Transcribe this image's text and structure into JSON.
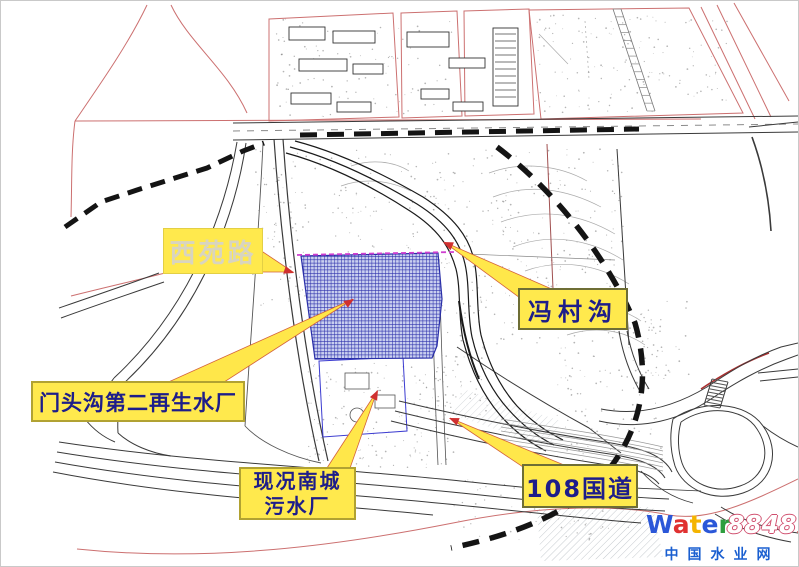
{
  "page": {
    "background": "#ffffff",
    "frame_color": "#c9c9c9"
  },
  "callouts": {
    "xiyuan_road": {
      "text": "西苑路"
    },
    "mentougou_plant": {
      "text": "门头沟第二再生水厂"
    },
    "fengcun_gou": {
      "text": "冯村沟"
    },
    "nancheng_plant": {
      "line1": "现况南城",
      "line2": "污水厂"
    },
    "g108": {
      "text": "108国道"
    }
  },
  "colors": {
    "label_bg": "#ffe94d",
    "label_text_blue": "#1d1d8a",
    "label_text_pale": "#d8d4c0",
    "site_hatch_blue": "#2d31ab",
    "boundary_dash": "#141414",
    "parcel_red": "#cc7070",
    "arrow_red": "#d03030",
    "magenta_edge": "#cf3fd0"
  },
  "watermark": {
    "brand_letters": [
      {
        "ch": "W",
        "color": "#2b57d8"
      },
      {
        "ch": "a",
        "color": "#e03131"
      },
      {
        "ch": "t",
        "color": "#f4b400"
      },
      {
        "ch": "e",
        "color": "#2b57d8"
      },
      {
        "ch": "r",
        "color": "#2e9e3e"
      }
    ],
    "brand_suffix": "8848",
    "brand_domain": ".com",
    "site_name": "中国水业网",
    "site_name_color": "#1a5fd0"
  }
}
